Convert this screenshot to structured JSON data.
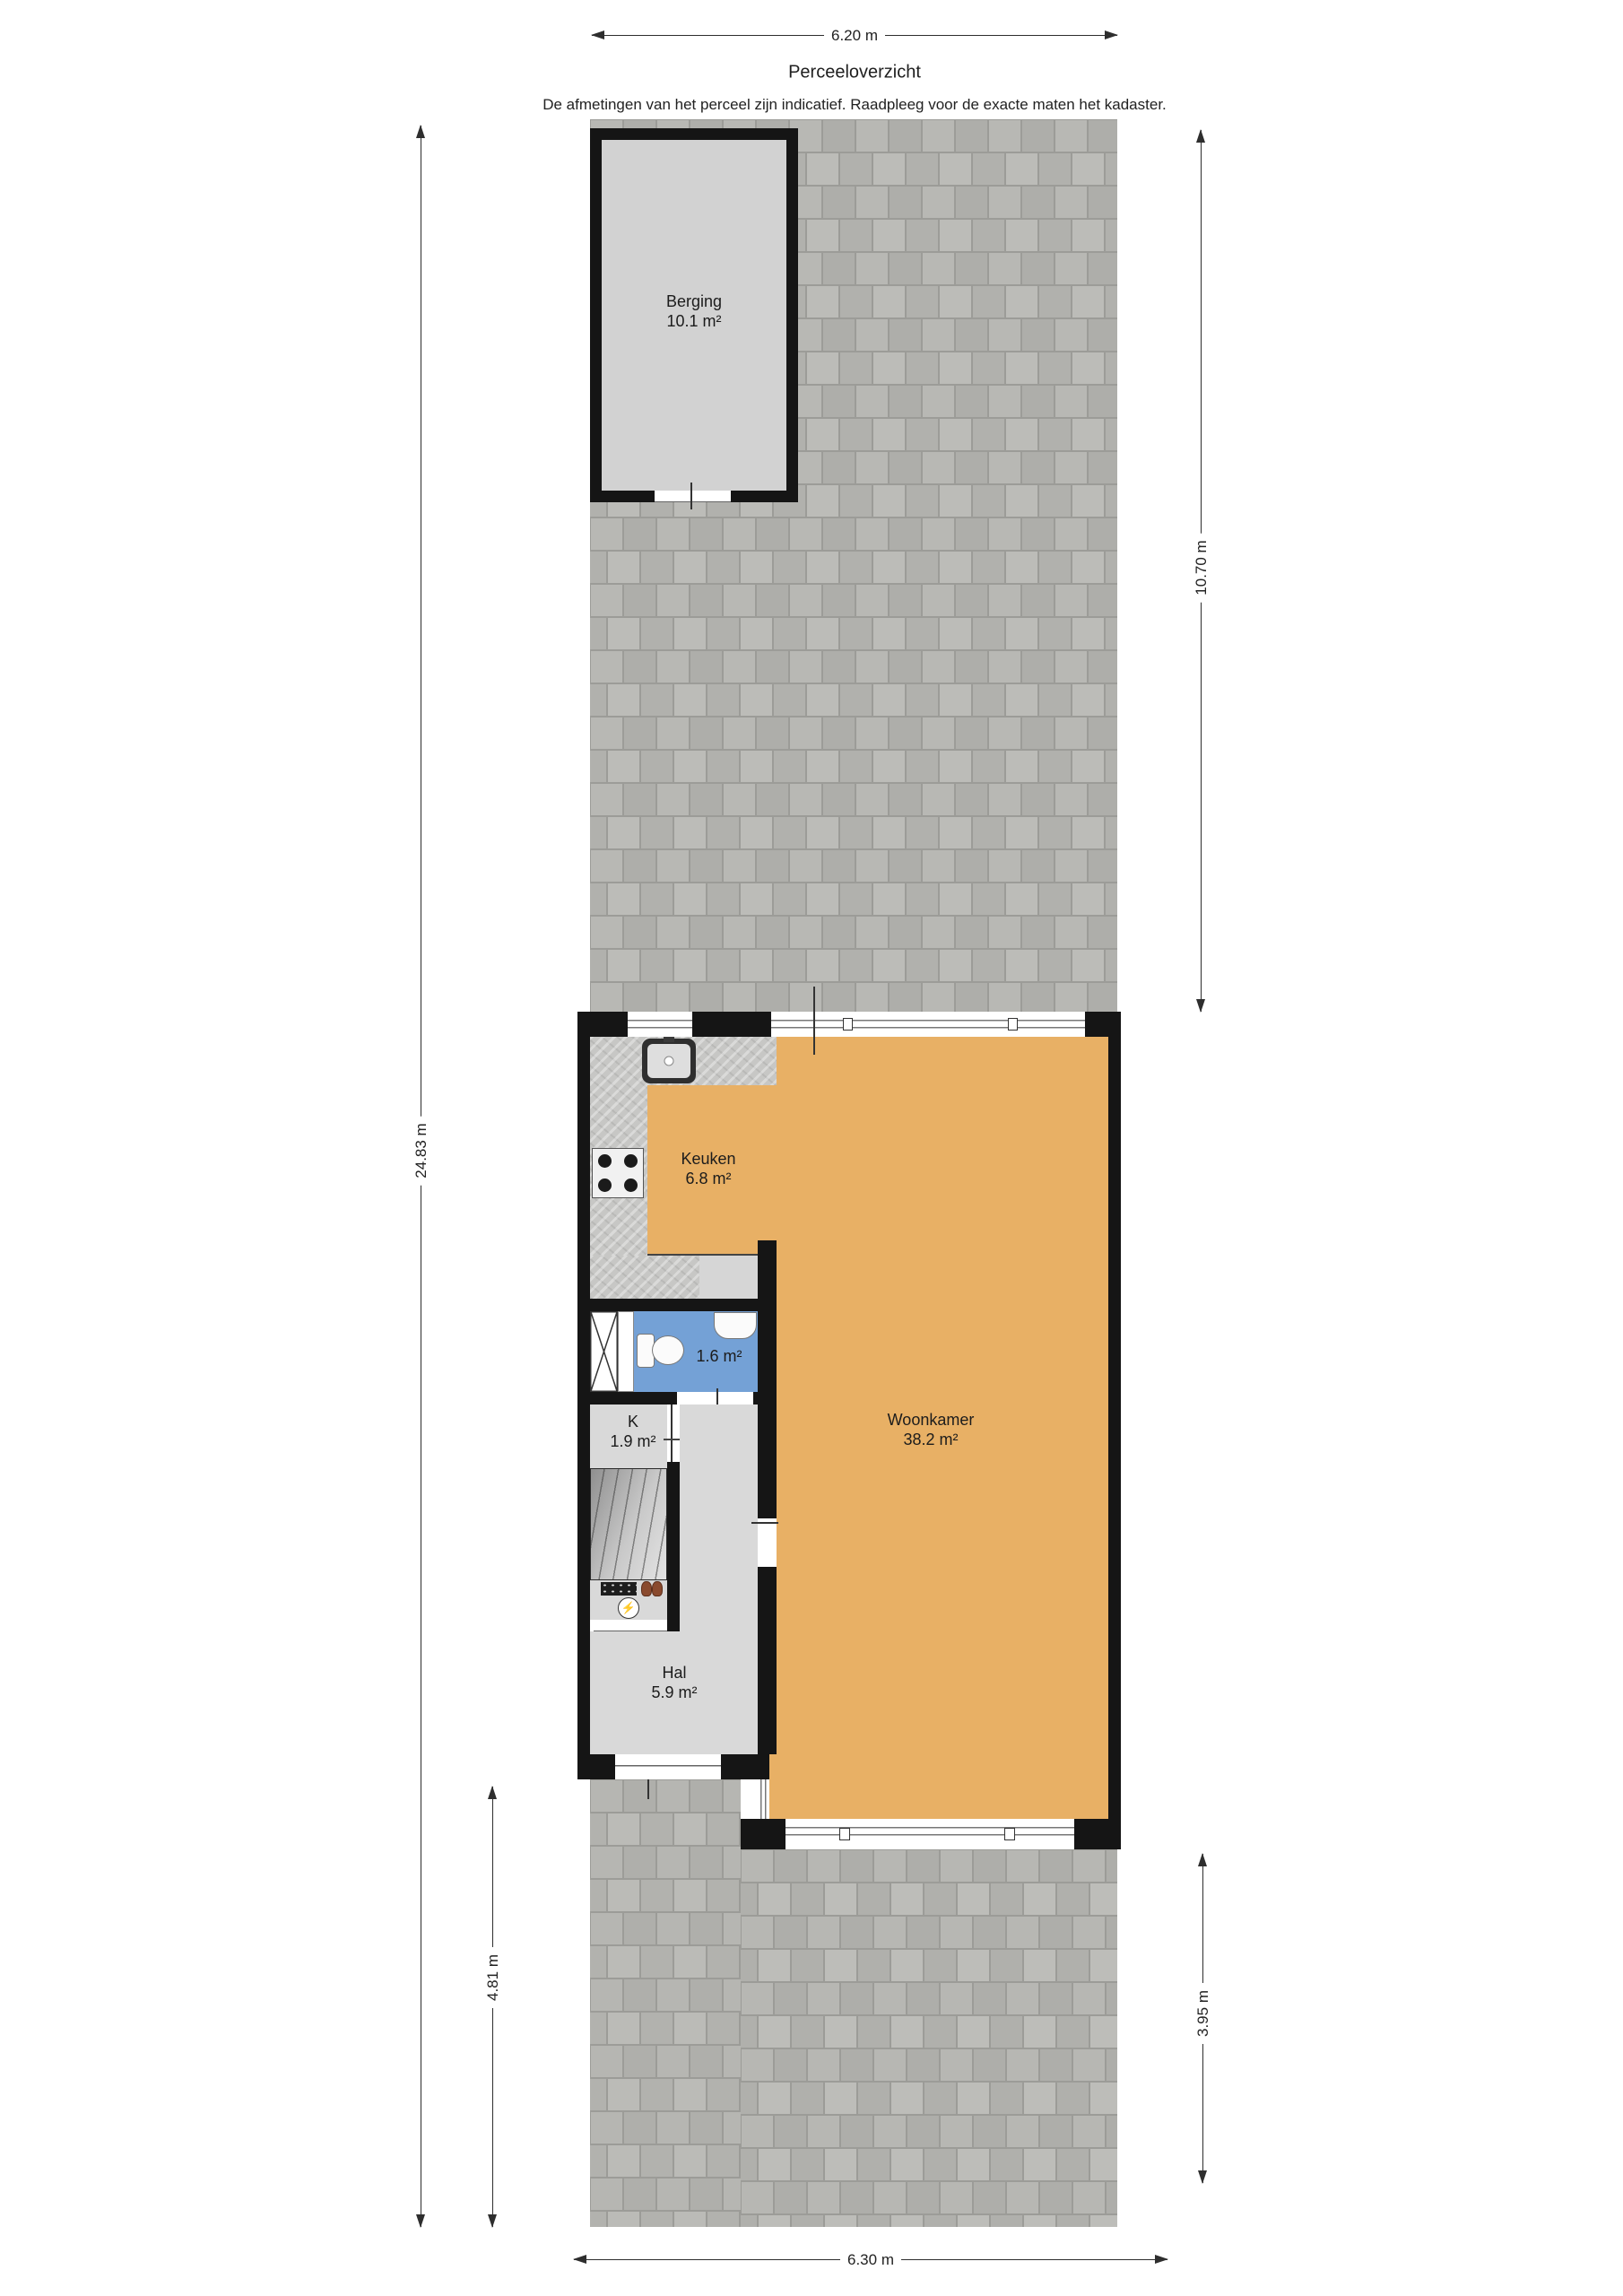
{
  "header": {
    "title": "Perceeloverzicht",
    "disclaimer": "De afmetingen van het perceel zijn indicatief. Raadpleeg voor de exacte maten het kadaster."
  },
  "dimensions": {
    "top_width": "6.20 m",
    "left_total_depth": "24.83 m",
    "right_back_garden_depth": "10.70 m",
    "front_left_depth": "4.81 m",
    "front_right_depth": "3.95 m",
    "bottom_width": "6.30 m"
  },
  "rooms": {
    "berging": {
      "name": "Berging",
      "area": "10.1 m²"
    },
    "keuken": {
      "name": "Keuken",
      "area": "6.8 m²"
    },
    "woonkamer": {
      "name": "Woonkamer",
      "area": "38.2 m²"
    },
    "toilet": {
      "area": "1.6 m²"
    },
    "kast": {
      "name": "K",
      "area": "1.9 m²"
    },
    "hal": {
      "name": "Hal",
      "area": "5.9 m²"
    }
  },
  "icons": {
    "electric_meter_glyph": "⚡"
  },
  "colors": {
    "wall": "#151515",
    "living_floor": "#e8b065",
    "toilet_floor": "#74a1d6",
    "hall_floor": "#d9d9d9",
    "berging_floor": "#d2d2d2",
    "paving_tile": "#b4b4b0",
    "paving_joint": "#9c9c98"
  }
}
